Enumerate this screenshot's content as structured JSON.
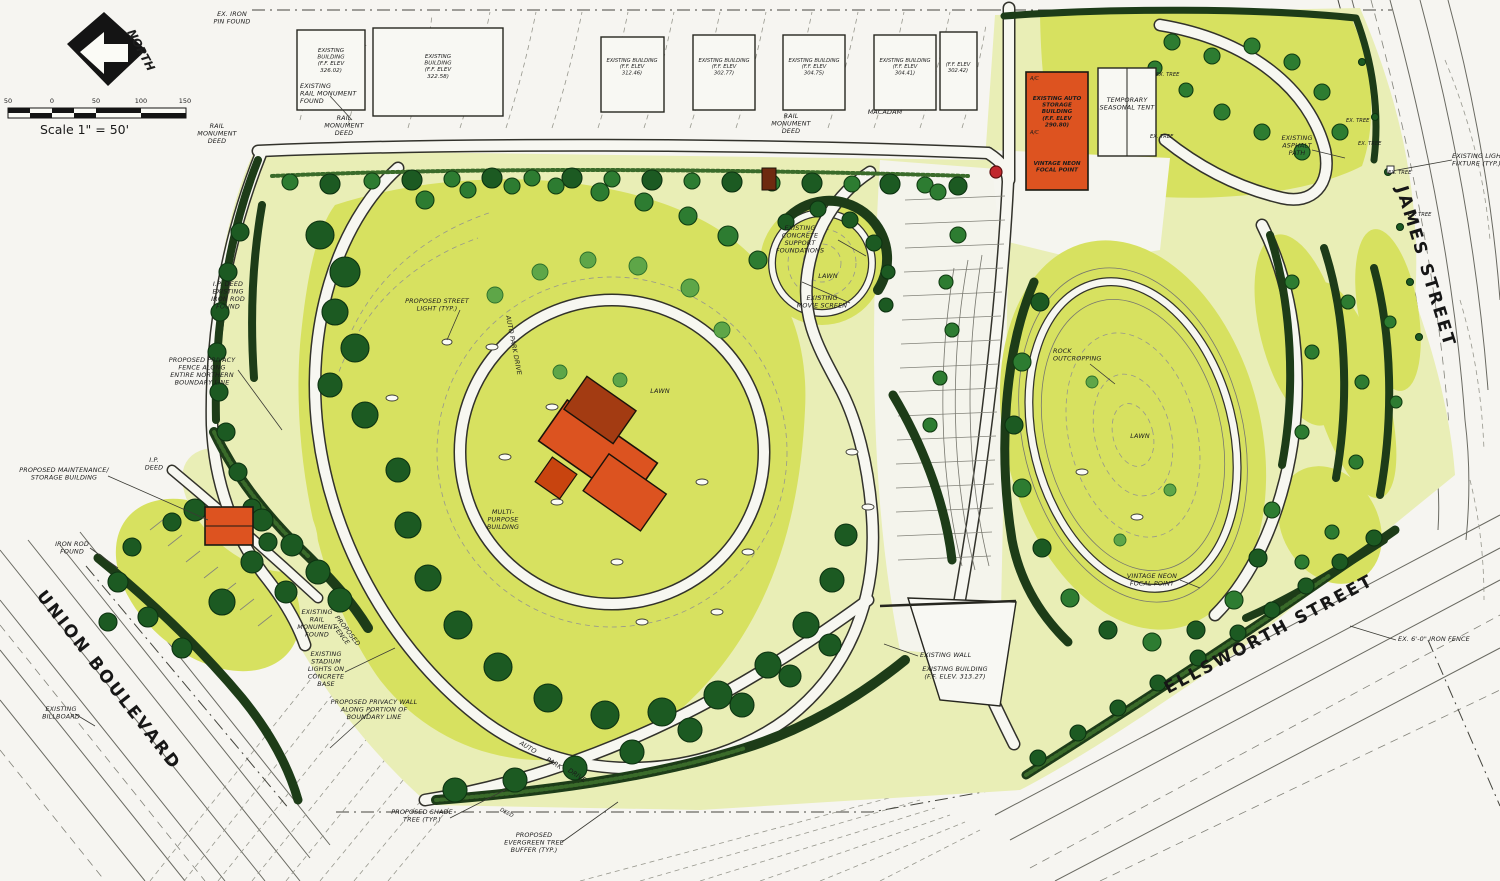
{
  "plan": {
    "compass": {
      "label": "NORTH"
    },
    "scale_bar": {
      "ticks": [
        "50",
        "0",
        "50",
        "100",
        "150"
      ],
      "label": "Scale 1\" = 50'"
    },
    "streets": {
      "union_boulevard": "UNION BOULEVARD",
      "ellsworth_street": "ELLSWORTH STREET",
      "james_street": "JAMES STREET",
      "auto_park_drive_upper": "AUTO PARK DRIVE",
      "auto_park_drive_words": [
        "AUTO",
        "PARK",
        "DRIVE"
      ]
    },
    "buildings": {
      "top_row": [
        "EXISTING\nBUILDING\n(F.F. ELEV\n326.02)",
        "EXISTING\nBUILDING\n(F.F. ELEV\n322.58)",
        "EXISTING BUILDING\n(F.F. ELEV\n312.46)",
        "EXISTING BUILDING\n(F.F. ELEV\n302.77)",
        "EXISTING BUILDING\n(F.F. ELEV\n304.75)",
        "EXISTING BUILDING\n(F.F. ELEV\n304.41)",
        "(F.F. ELEV\n302.42)"
      ],
      "auto_storage": {
        "label": "EXISTING AUTO\nSTORAGE\nBUILDING\n(F.F. ELEV\n290.80)",
        "ac_label": "A/C",
        "focal_point": "VINTAGE NEON\nFOCAL POINT"
      },
      "seasonal_tent": "TEMPORARY\nSEASONAL TENT",
      "multi_purpose": "MULTI-\nPURPOSE\nBUILDING",
      "wall_building": {
        "wall": "EXISTING WALL",
        "label": "EXISTING BUILDING\n(F.F. ELEV. 313.27)"
      }
    },
    "ex_tree_label": "EX. TREE",
    "annotations": [
      {
        "text": "EX. IRON\nPIN FOUND"
      },
      {
        "text": "RAIL\nMONUMENT\nDEED"
      },
      {
        "text": "EXISTING\nRAIL MONUMENT\nFOUND"
      },
      {
        "text": "RAIL\nMONUMENT\nDEED"
      },
      {
        "text": "RAIL\nMONUMENT\nDEED"
      },
      {
        "text": "MACADAM"
      },
      {
        "text": "EXISTING\nCONCRETE\nSUPPORT\nFOUNDATIONS"
      },
      {
        "text": "LAWN"
      },
      {
        "text": "EXISTING\nMOVIE SCREEN"
      },
      {
        "text": "PROPOSED STREET\nLIGHT (TYP.)"
      },
      {
        "text": "LAWN"
      },
      {
        "text": "ROCK\nOUTCROPPING"
      },
      {
        "text": "LAWN"
      },
      {
        "text": "VINTAGE NEON\nFOCAL POINT"
      },
      {
        "text": "EXISTING\nASPHALT\nPATH"
      },
      {
        "text": "EXISTING LIGHT\nFIXTURE (TYP.)"
      },
      {
        "text": "I.P. DEED\nEXISTING\nIRON ROD\nFOUND"
      },
      {
        "text": "PROPOSED PRIVACY\nFENCE ALONG\nENTIRE NORTHERN\nBOUNDARY LINE"
      },
      {
        "text": "PROPOSED MAINTENANCE/\nSTORAGE BUILDING"
      },
      {
        "text": "I.P.\nDEED"
      },
      {
        "text": "IRON ROD\nFOUND"
      },
      {
        "text": "EXISTING\nBILLBOARD"
      },
      {
        "text": "EXISTING\nRAIL\nMONUMENT\nFOUND"
      },
      {
        "text": "PROPOSED\nFENCE"
      },
      {
        "text": "EXISTING\nSTADIUM\nLIGHTS ON\nCONCRETE\nBASE"
      },
      {
        "text": "PROPOSED PRIVACY WALL\nALONG PORTION OF\nBOUNDARY LINE"
      },
      {
        "text": "PROPOSED SHADE\nTREE (TYP.)"
      },
      {
        "text": "DEED"
      },
      {
        "text": "PROPOSED\nEVERGREEN TREE\nBUFFER (TYP.)"
      },
      {
        "text": "EX. 6'-0\" IRON FENCE"
      }
    ]
  }
}
